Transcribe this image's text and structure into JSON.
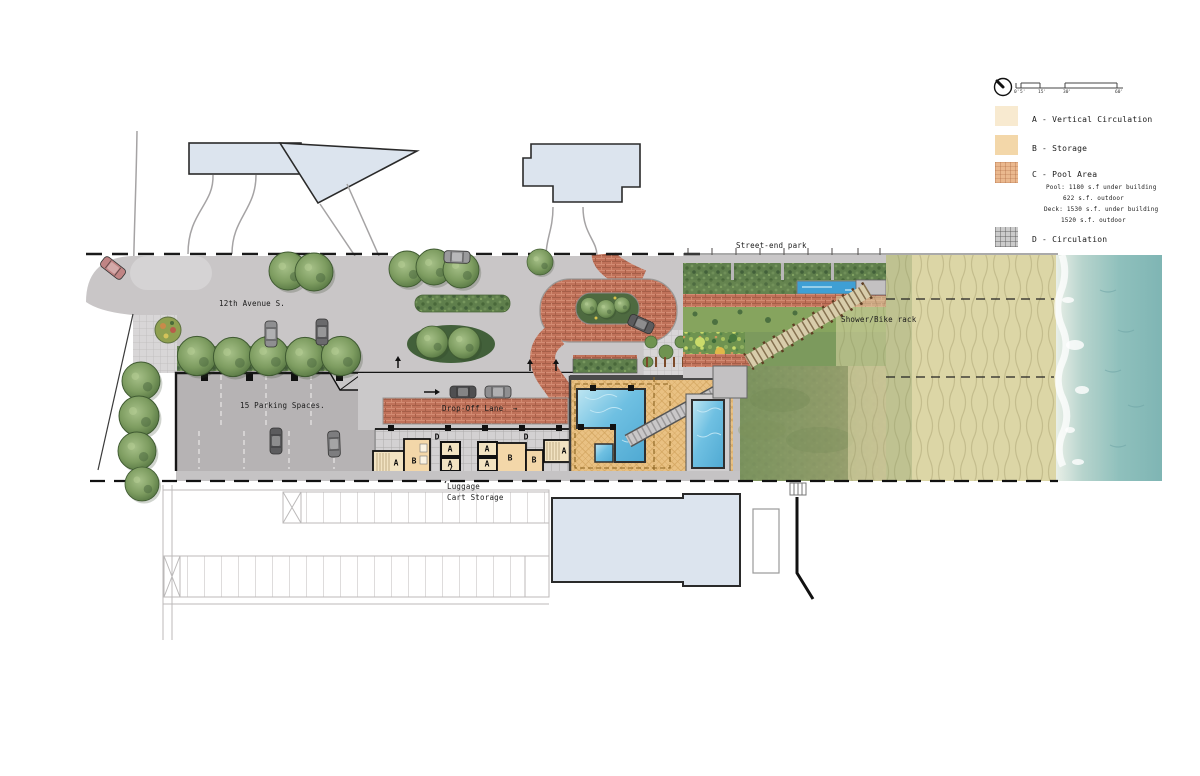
{
  "labels": {
    "street_name": "12th Avenue S.",
    "parking": "15 Parking Spaces.",
    "dropoff": "Drop-Off Lane",
    "arrow_right": "→",
    "luggage_1": "Luggage",
    "luggage_2": "Cart Storage",
    "street_end_park": "Street-end park",
    "shower_bike": "Shower/Bike rack"
  },
  "rooms": {
    "a": [
      "A",
      "A",
      "A",
      "A",
      "A",
      "A"
    ],
    "b": [
      "B",
      "B",
      "B"
    ],
    "d": [
      "D",
      "D"
    ]
  },
  "legend": {
    "items": [
      {
        "key": "A",
        "label": "A - Vertical Circulation",
        "color": "#f8ead0"
      },
      {
        "key": "B",
        "label": "B - Storage",
        "color": "#f3d7a9"
      },
      {
        "key": "C",
        "label": "C - Pool Area",
        "color": "#eab88e",
        "details": [
          "Pool: 1180 s.f under building",
          "622 s.f. outdoor",
          "Deck: 1530 s.f. under building",
          "1520 s.f. outdoor"
        ]
      },
      {
        "key": "D",
        "label": "D - Circulation",
        "color": "#cbcbcb"
      }
    ],
    "scale_ticks": [
      "0'",
      "5'",
      "15'",
      "30'",
      "60'"
    ]
  },
  "colors": {
    "brick": "#c0725a",
    "deck_tan": "#e9c183",
    "pool_water": "#58b4da",
    "street_gray": "#c9c6c7",
    "parking_gray": "#b6b3b4",
    "neighbor_building": "#dce4ee",
    "hedge_green": "#5f7f4c",
    "sand": "#dcd6a6",
    "water": "#7fb5b4"
  }
}
